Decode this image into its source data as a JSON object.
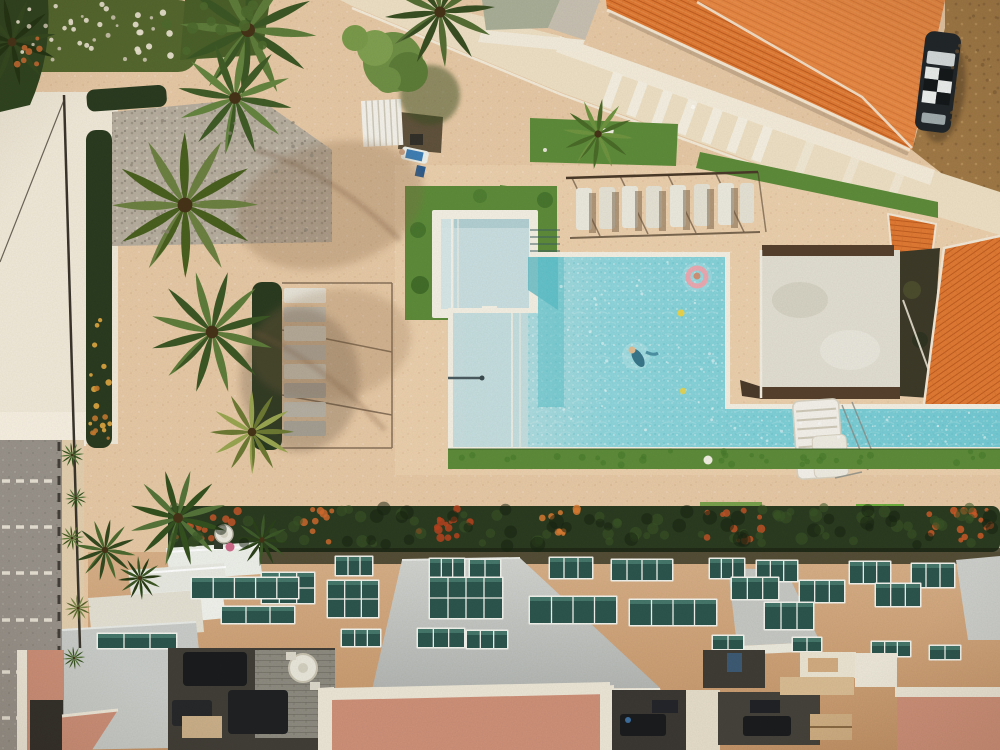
{
  "meta": {
    "type": "aerial-drone-photograph",
    "description": "Top-down aerial view of a beach resort: turquoise swimming pool with kiddie pool and lap lane, sun loungers under pergolas, palm trees, terracotta tiled roofs, parked car, parking strip, flowering hedge row and an apartment building rooftop with balconies, skylight windows and salmon-pink roof terraces with patio furniture.",
    "width": 1000,
    "height": 750
  },
  "colors": {
    "sand": "#e7c9a5",
    "deckSand": "#ecd0ad",
    "whiteSand": "#f1e9d8",
    "sidewalk": "#e3cfae",
    "asphalt": "#98928a",
    "walkway": "#eee0c4",
    "walkwayLight": "#f7f0e1",
    "dirt": "#a07946",
    "grass": "#5d8c3a",
    "grassBright": "#6fae3f",
    "hedge": "#2a3b20",
    "palm": "#5f7d3b",
    "palmDark": "#3c5724",
    "palmLight": "#9aa651",
    "tree": "#6f8f45",
    "flowerWhite": "#e9e3cf",
    "flowerOrange": "#c65f2d",
    "flowerYellow": "#d9a33f",
    "roofOrange": "#e07a33",
    "roofLight": "#ef9a57",
    "ridge": "#f4e8d4",
    "tileLine": "#b05018",
    "pad": "#e2dfd2",
    "padDark": "#55402c",
    "poolRim": "#f4f0e3",
    "water": "#84d2d9",
    "waterShallow": "#c6dedf",
    "waterDeep": "#58bcc7",
    "kiddie": "#cadfe1",
    "facade": "#d2a87d",
    "glass": "#2c554d",
    "frame": "#f2f2ec",
    "slab": "#c7c9c5",
    "cream": "#ebe4d1",
    "salmon": "#ce9078",
    "courtyard": "#413e37",
    "couch": "#1a1c1e",
    "brick": "#8d8a80",
    "table": "#e9e6da",
    "carBody": "#20262a",
    "carWhite": "#d8dfdf",
    "shadow": "#6b4c32"
  },
  "scene": {
    "objects": [
      "main-swimming-pool",
      "kiddie-pool",
      "lap-pool-section",
      "pool-ladder-platform",
      "swimmer-with-pink-ring",
      "swimmer",
      "sun-loungers-row-top",
      "sun-loungers-column-left",
      "pergola-frames",
      "white-cabana-fence",
      "big-orange-roof",
      "small-orange-roof",
      "lower-orange-roof",
      "parked-checkered-car",
      "concrete-sports-pad",
      "palm-trees",
      "flower-bed",
      "hedge-row-with-flowers",
      "apartment-rooftop",
      "balconies",
      "skylight-windows",
      "salmon-roof-terraces",
      "patio-courtyards",
      "round-patio-table",
      "parking-strip",
      "light-pole",
      "satellite-dish",
      "dirt-ground",
      "white-walkway"
    ],
    "windows": [
      [
        336,
        557,
        36,
        18,
        3
      ],
      [
        430,
        559,
        34,
        18,
        3
      ],
      [
        470,
        560,
        30,
        18,
        2
      ],
      [
        550,
        558,
        42,
        20,
        3
      ],
      [
        612,
        560,
        60,
        20,
        4
      ],
      [
        710,
        559,
        34,
        19,
        3
      ],
      [
        757,
        561,
        40,
        20,
        3
      ],
      [
        850,
        562,
        40,
        21,
        3
      ],
      [
        912,
        564,
        42,
        23,
        3
      ],
      [
        262,
        573,
        52,
        30,
        3
      ],
      [
        328,
        581,
        50,
        36,
        3
      ],
      [
        430,
        578,
        72,
        40,
        4
      ],
      [
        530,
        597,
        86,
        26,
        4
      ],
      [
        630,
        600,
        86,
        25,
        4
      ],
      [
        732,
        578,
        46,
        21,
        3
      ],
      [
        800,
        581,
        44,
        21,
        3
      ],
      [
        876,
        584,
        44,
        22,
        3
      ],
      [
        765,
        603,
        48,
        26,
        3
      ],
      [
        342,
        630,
        38,
        16,
        3
      ],
      [
        418,
        629,
        46,
        18,
        3
      ],
      [
        467,
        631,
        40,
        17,
        3
      ],
      [
        713,
        636,
        30,
        13,
        2
      ],
      [
        793,
        638,
        28,
        13,
        2
      ],
      [
        192,
        578,
        106,
        20,
        5
      ],
      [
        222,
        607,
        72,
        16,
        3
      ],
      [
        98,
        634,
        78,
        14,
        3
      ],
      [
        872,
        642,
        38,
        14,
        3
      ],
      [
        930,
        646,
        30,
        13,
        2
      ]
    ],
    "hedge_flower_clusters": [
      [
        175,
        245,
        "#c4572a",
        14
      ],
      [
        298,
        338,
        "#cf6a2e",
        10
      ],
      [
        415,
        472,
        "#b8431f",
        14
      ],
      [
        538,
        578,
        "#d97b33",
        9
      ],
      [
        698,
        762,
        "#c05327",
        12
      ],
      [
        925,
        998,
        "#cc5a28",
        16
      ]
    ],
    "scatters": [
      {
        "x0": 18,
        "x1": 180,
        "y0": 4,
        "y1": 62,
        "n": 26,
        "c": "#e9e3cf",
        "r": 2.6,
        "o": 0.95
      },
      {
        "x0": 25,
        "x1": 175,
        "y0": 8,
        "y1": 60,
        "n": 14,
        "c": "#cfc8b2",
        "r": 2.0,
        "o": 0.9
      },
      {
        "x0": 16,
        "x1": 52,
        "y0": 36,
        "y1": 68,
        "n": 7,
        "c": "#c66a32",
        "r": 2.8,
        "o": 0.9
      },
      {
        "x0": 150,
        "x1": 265,
        "y0": 2,
        "y1": 55,
        "n": 12,
        "c": "#4e6a2d",
        "r": 5,
        "o": 0.9
      },
      {
        "x0": 90,
        "x1": 110,
        "y0": 318,
        "y1": 445,
        "n": 12,
        "c": "#d9a33f",
        "r": 2.6,
        "o": 0.95
      },
      {
        "x0": 90,
        "x1": 110,
        "y0": 360,
        "y1": 448,
        "n": 7,
        "c": "#c47a2f",
        "r": 2.4,
        "o": 0.9
      },
      {
        "x0": 172,
        "x1": 995,
        "y0": 506,
        "y1": 544,
        "n": 70,
        "c": "#3a5526",
        "r": 5,
        "o": 0.55
      },
      {
        "x0": 172,
        "x1": 995,
        "y0": 508,
        "y1": 546,
        "n": 45,
        "c": "#16220f",
        "r": 6,
        "o": 0.5
      },
      {
        "x0": 452,
        "x1": 995,
        "y0": 451,
        "y1": 465,
        "n": 34,
        "c": "#477a2b",
        "r": 3,
        "o": 0.6
      },
      {
        "x0": 556,
        "x1": 720,
        "y0": 262,
        "y1": 440,
        "n": 30,
        "c": "#ffffff",
        "r": 1.3,
        "o": 0.5
      },
      {
        "x0": 730,
        "x1": 990,
        "y0": 412,
        "y1": 442,
        "n": 20,
        "c": "#ffffff",
        "r": 1.2,
        "o": 0.5
      },
      {
        "x0": 944,
        "x1": 998,
        "y0": 5,
        "y1": 160,
        "n": 18,
        "c": "#7a5a34",
        "r": 1.6,
        "o": 0.6
      },
      {
        "x0": 115,
        "x1": 325,
        "y0": 118,
        "y1": 240,
        "n": 26,
        "c": "#8d8476",
        "r": 1.6,
        "o": 0.7
      }
    ],
    "parking_dash_rows": [
      481,
      527,
      573,
      620,
      672,
      718
    ],
    "lounger_rows": {
      "top_count": 8,
      "left_count": 8
    }
  }
}
